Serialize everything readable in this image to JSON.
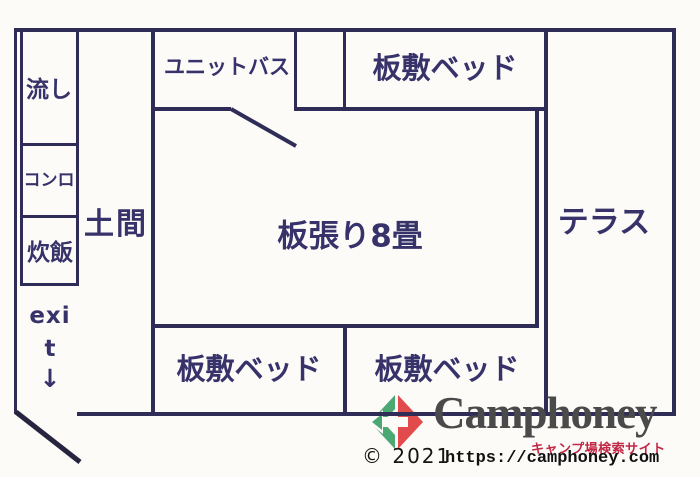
{
  "plan": {
    "labels": {
      "sink": "流し",
      "stove": "コンロ",
      "rice_cooker": "炊飯",
      "doma": "土間",
      "unit_bath": "ユニットバス",
      "bed_top": "板敷ベッド",
      "main_room": "板張り8畳",
      "terrace": "テラス",
      "bed_bottom_left": "板敷ベッド",
      "bed_bottom_right": "板敷ベッド"
    },
    "exit": {
      "line1": "exi",
      "line2": "t",
      "arrow": "↓"
    },
    "colors": {
      "wall": "#2f2d58",
      "label": "#37336a"
    }
  },
  "watermark": {
    "brand": "Camphoney",
    "tagline": "キャンプ場検索サイト",
    "copyright": "© 2021",
    "url": "https://camphoney.com",
    "icon": "camphoney-diamond-arrow-icon",
    "colors": {
      "brand_text": "#4a4a4a",
      "tagline": "#c22746",
      "icon_green": "#4ba872",
      "icon_red": "#e14b4b"
    }
  }
}
